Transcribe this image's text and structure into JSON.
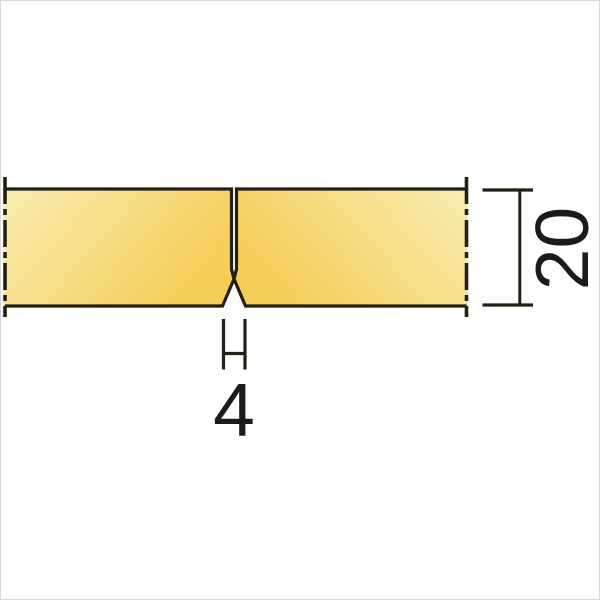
{
  "dimensions": {
    "thickness": "20",
    "groove_width": "4"
  },
  "colors": {
    "line": "#221f14",
    "text": "#1b1b1b",
    "panel_light": "#f9edb3",
    "panel_gold": "#f5ce58",
    "background": "#ffffff",
    "frame": "#d8d8d8"
  }
}
